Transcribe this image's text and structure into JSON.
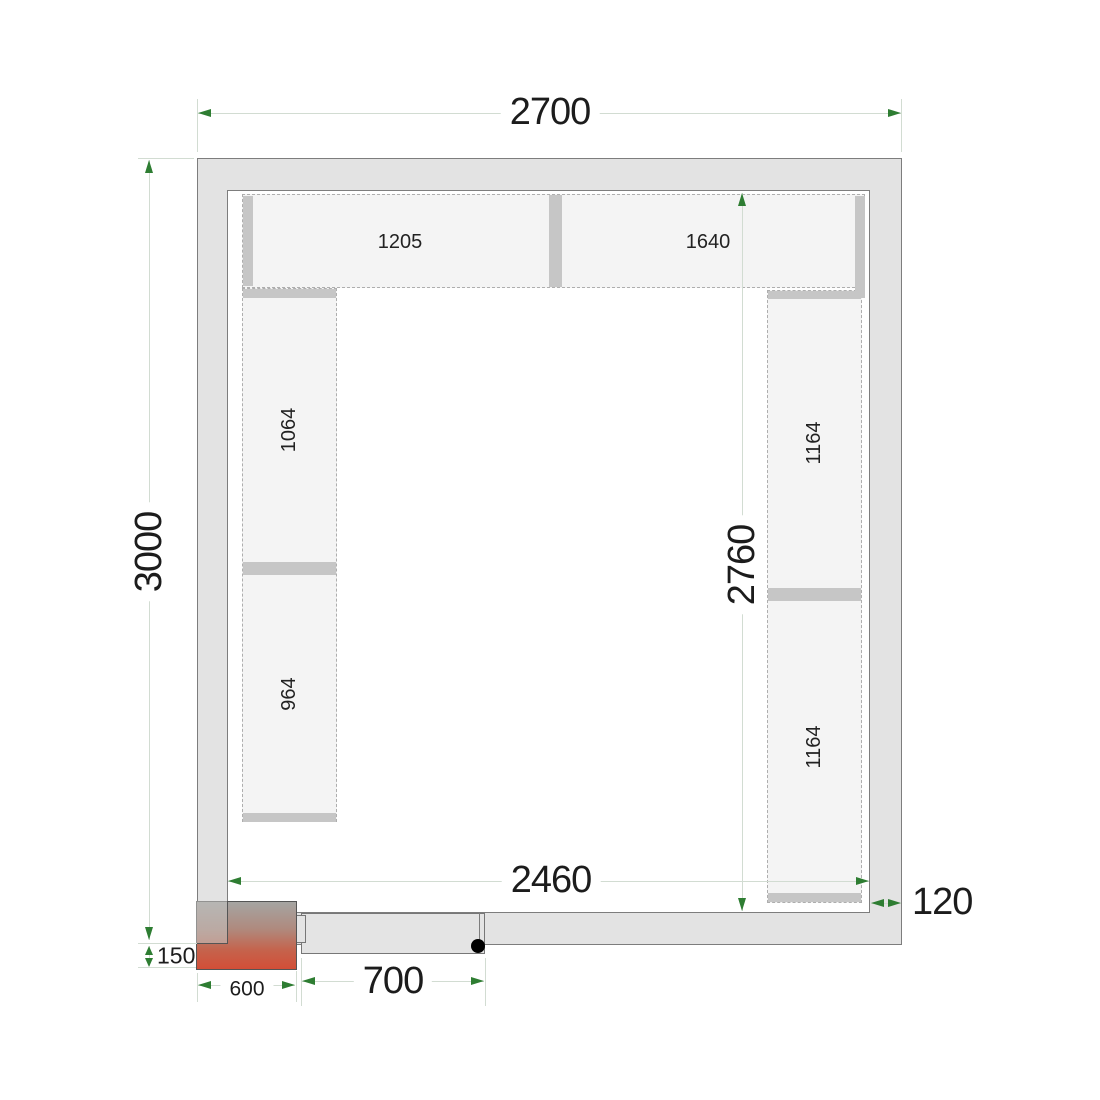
{
  "diagram": {
    "kind": "cold-room-floor-plan",
    "dimensions": {
      "outer_width": "2700",
      "outer_depth": "3000",
      "inner_width": "2460",
      "inner_depth": "2760",
      "wall_thickness": "120",
      "door_width": "700",
      "cooling_unit_width": "600",
      "cooling_unit_protrusion": "150"
    },
    "shelves": {
      "top": [
        {
          "label": "1205"
        },
        {
          "label": "1640"
        }
      ],
      "left": [
        {
          "label": "1064"
        },
        {
          "label": "964"
        }
      ],
      "right": [
        {
          "label": "1164"
        },
        {
          "label": "1164"
        }
      ]
    },
    "colors": {
      "wall_fill": "#e3e3e3",
      "shelf_fill": "#f4f4f4",
      "support_bar": "#c6c6c6",
      "dimension_line": "#d2dcd2",
      "arrow_green": "#2e7d32",
      "unit_gradient_top": "#a5a5a2",
      "unit_gradient_bottom": "#d24e37"
    }
  }
}
